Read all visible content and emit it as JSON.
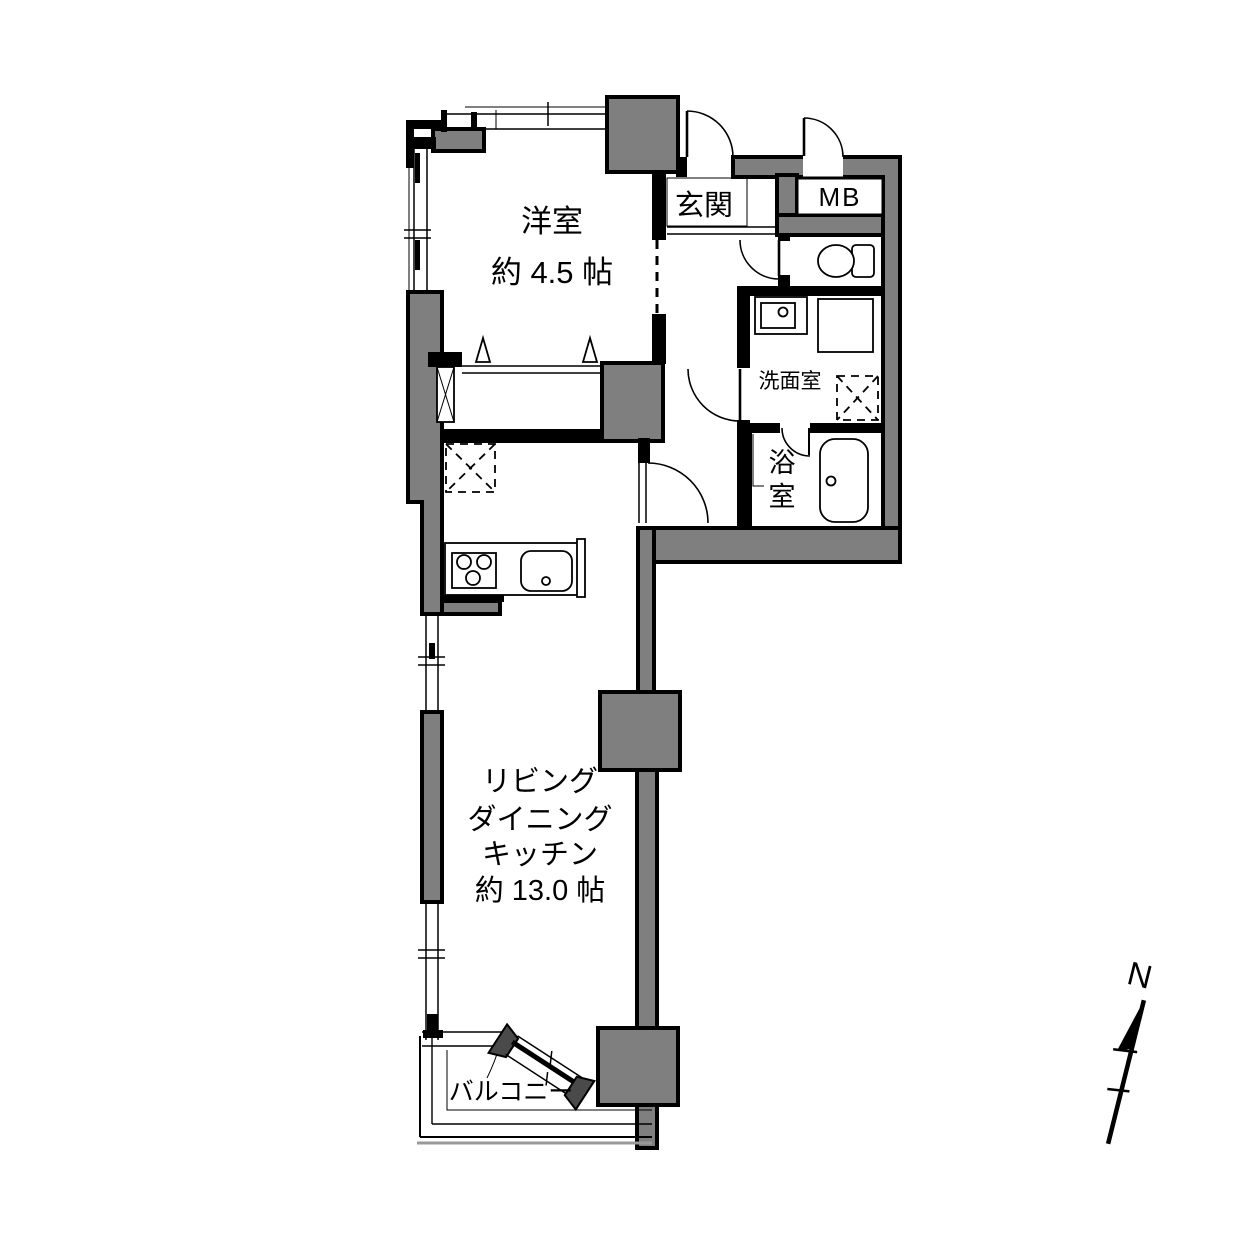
{
  "floor_plan": {
    "rooms": {
      "western": {
        "name": "洋室",
        "size": "約 4.5 帖"
      },
      "entrance": {
        "label": "玄関"
      },
      "meter_box": {
        "label": "MB"
      },
      "washroom": {
        "label": "洗面室"
      },
      "bathroom": {
        "label": "浴室",
        "char1": "浴",
        "char2": "室"
      },
      "ldk": {
        "line1": "リビング",
        "line2": "ダイニング",
        "line3": "キッチン",
        "line4": "約 13.0 帖"
      },
      "balcony": {
        "label": "バルコニー"
      }
    },
    "compass": {
      "north_label": "N"
    },
    "colors": {
      "wall_fill": "#7f7f7f",
      "line": "#000000",
      "background": "#ffffff"
    }
  }
}
